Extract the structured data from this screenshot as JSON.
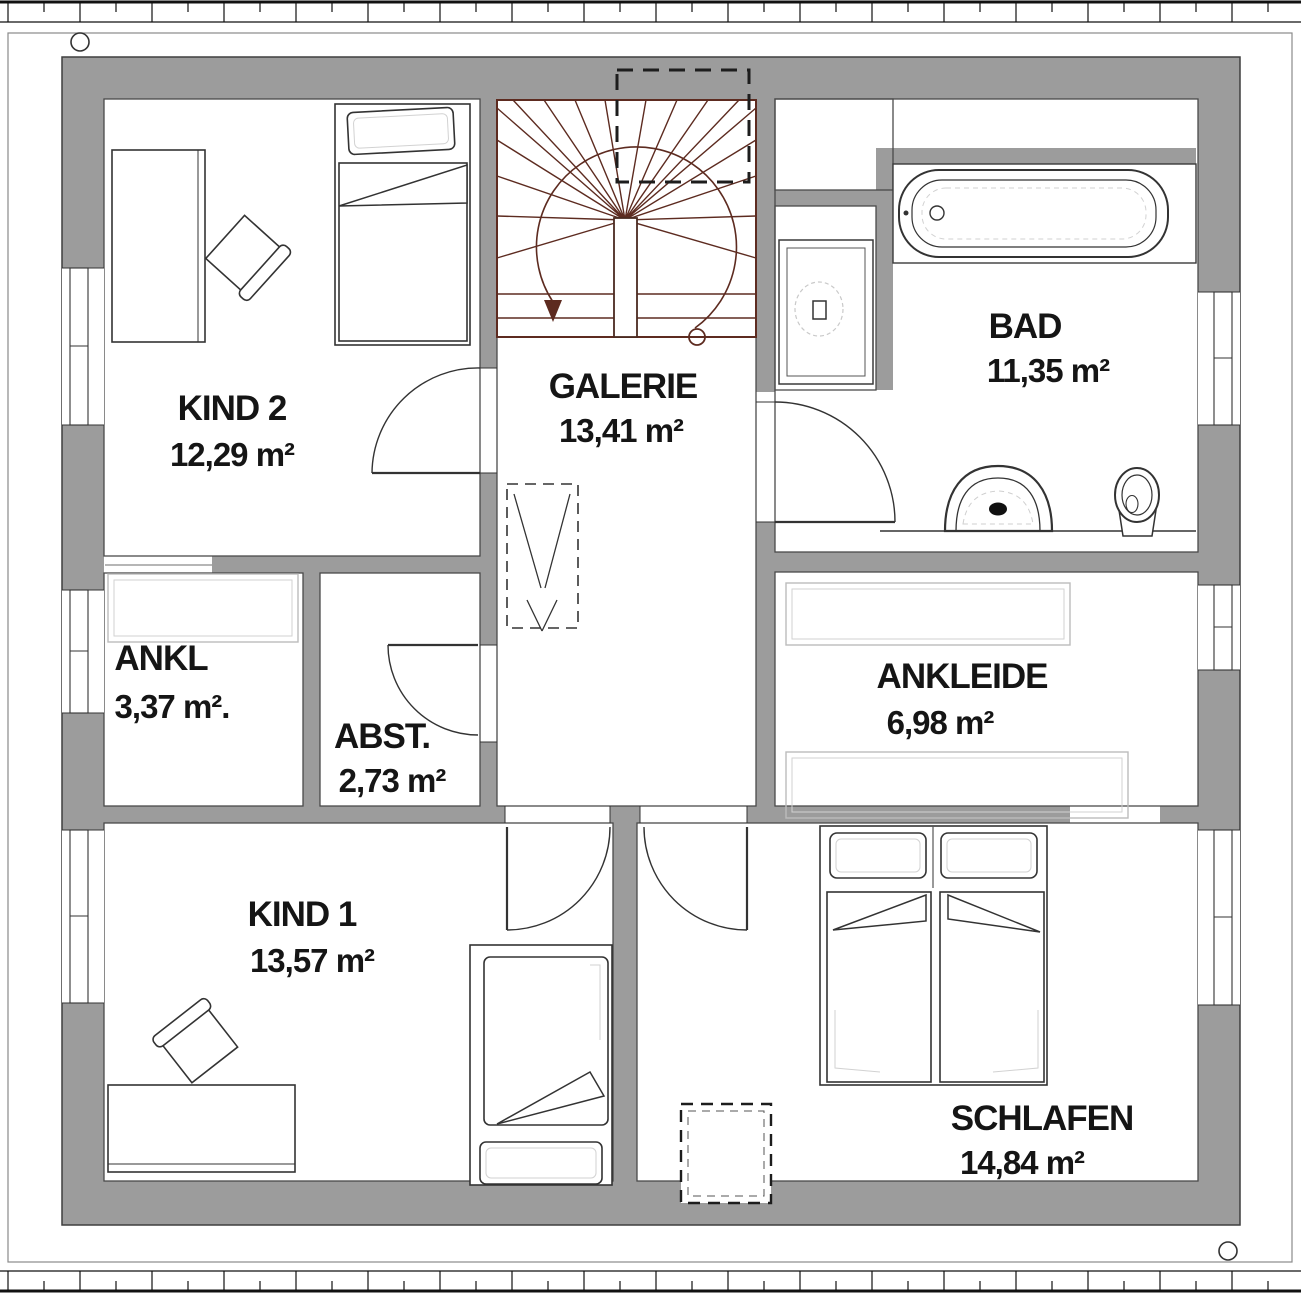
{
  "plan": {
    "title": "floor-plan-upper-storey",
    "rooms": [
      {
        "name": "KIND 2",
        "area": "12,29 m²"
      },
      {
        "name": "GALERIE",
        "area": "13,41 m²"
      },
      {
        "name": "BAD",
        "area": "11,35 m²"
      },
      {
        "name": "ANKL",
        "area": "3,37 m²."
      },
      {
        "name": "ABST.",
        "area": "2,73 m²"
      },
      {
        "name": "ANKLEIDE",
        "area": "6,98 m²"
      },
      {
        "name": "KIND 1",
        "area": "13,57 m²"
      },
      {
        "name": "SCHLAFEN",
        "area": "14,84 m²"
      }
    ],
    "colors": {
      "wall_gray": "#9c9c9c",
      "stair_red": "#5d2b20",
      "line_dark": "#333333",
      "furniture_light": "#bcbcbc"
    }
  }
}
